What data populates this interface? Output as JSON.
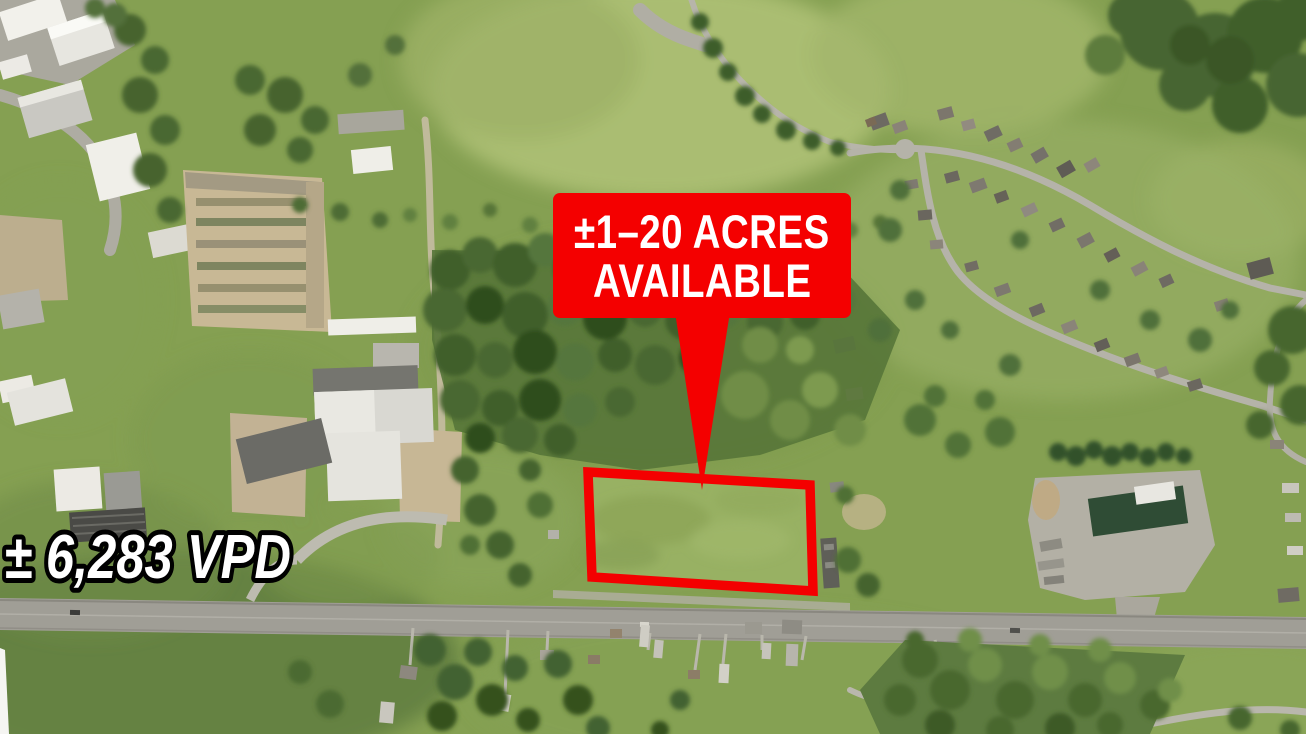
{
  "colors": {
    "accent_red": "#f40000",
    "callout_text": "#ffffff",
    "traffic_text_fill": "#ffffff",
    "traffic_text_stroke": "#000000"
  },
  "overlay": {
    "callout": {
      "line1": "±1–20 ACRES",
      "line2": "AVAILABLE"
    },
    "traffic_count": "± 6,283 VPD"
  }
}
